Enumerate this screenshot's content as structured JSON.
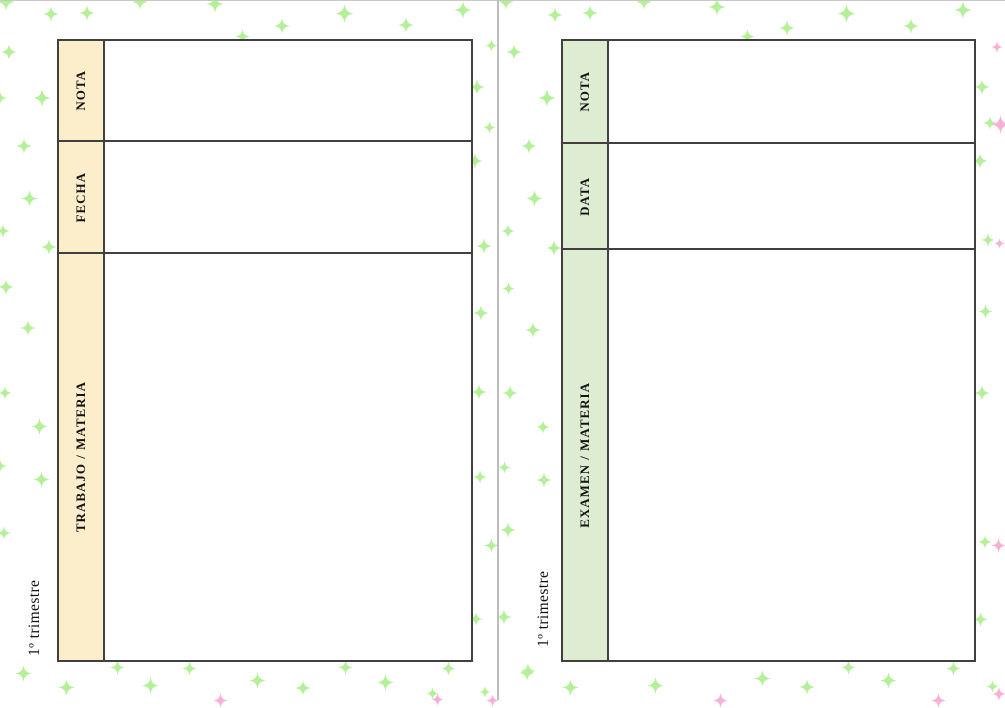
{
  "pages": {
    "left": {
      "title": "1º trimestre",
      "header_bg": "#fdeecb",
      "rows": [
        {
          "label": "NOTA"
        },
        {
          "label": "FECHA"
        },
        {
          "label": "TRABAJO / MATERIA"
        }
      ]
    },
    "right": {
      "title": "1º trimestre",
      "header_bg": "#deecd2",
      "rows": [
        {
          "label": "NOTA"
        },
        {
          "label": "DATA"
        },
        {
          "label": "EXAMEN / MATERIA"
        }
      ]
    }
  },
  "colors": {
    "table_border": "#404040",
    "page_divider": "#bdbdbd",
    "top_edge_line": "#c8c8c8",
    "text": "#131313"
  },
  "decor": {
    "sparkle_icon": "four-point-sparkle",
    "green": "#b4f098",
    "pink": "#f9b0d4",
    "green_sparkles": [
      [
        6,
        2,
        18
      ],
      [
        51,
        14,
        16
      ],
      [
        87,
        13,
        16
      ],
      [
        140,
        2,
        16
      ],
      [
        215,
        4,
        18
      ],
      [
        242,
        36,
        15
      ],
      [
        282,
        26,
        16
      ],
      [
        344,
        13,
        19
      ],
      [
        406,
        25,
        16
      ],
      [
        463,
        10,
        18
      ],
      [
        506,
        2,
        16
      ],
      [
        555,
        15,
        16
      ],
      [
        590,
        13,
        16
      ],
      [
        644,
        2,
        16
      ],
      [
        717,
        7,
        18
      ],
      [
        747,
        36,
        15
      ],
      [
        787,
        28,
        16
      ],
      [
        846,
        13,
        19
      ],
      [
        911,
        26,
        16
      ],
      [
        963,
        10,
        18
      ],
      [
        9,
        52,
        16
      ],
      [
        0,
        98,
        14
      ],
      [
        42,
        98,
        18
      ],
      [
        24,
        146,
        16
      ],
      [
        29,
        198,
        17
      ],
      [
        3,
        231,
        14
      ],
      [
        49,
        247,
        16
      ],
      [
        6,
        287,
        16
      ],
      [
        28,
        328,
        16
      ],
      [
        5,
        393,
        14
      ],
      [
        39,
        426,
        17
      ],
      [
        0,
        466,
        14
      ],
      [
        41,
        479,
        17
      ],
      [
        4,
        533,
        14
      ],
      [
        23,
        673,
        17
      ],
      [
        491,
        45,
        13
      ],
      [
        477,
        87,
        16
      ],
      [
        489,
        127,
        13
      ],
      [
        475,
        161,
        16
      ],
      [
        484,
        246,
        16
      ],
      [
        481,
        313,
        16
      ],
      [
        479,
        392,
        16
      ],
      [
        480,
        477,
        14
      ],
      [
        491,
        545,
        15
      ],
      [
        476,
        619,
        14
      ],
      [
        514,
        52,
        16
      ],
      [
        547,
        98,
        18
      ],
      [
        529,
        146,
        16
      ],
      [
        534,
        198,
        17
      ],
      [
        508,
        231,
        14
      ],
      [
        554,
        248,
        16
      ],
      [
        508,
        288,
        13
      ],
      [
        533,
        330,
        16
      ],
      [
        510,
        393,
        16
      ],
      [
        543,
        427,
        14
      ],
      [
        504,
        467,
        13
      ],
      [
        544,
        480,
        16
      ],
      [
        508,
        530,
        16
      ],
      [
        504,
        617,
        16
      ],
      [
        528,
        671,
        16
      ],
      [
        982,
        87,
        16
      ],
      [
        990,
        123,
        14
      ],
      [
        980,
        161,
        16
      ],
      [
        988,
        240,
        14
      ],
      [
        985,
        311,
        15
      ],
      [
        982,
        393,
        16
      ],
      [
        985,
        542,
        14
      ],
      [
        980,
        619,
        15
      ],
      [
        992,
        686,
        13
      ],
      [
        66,
        687,
        17
      ],
      [
        117,
        667,
        15
      ],
      [
        150,
        685,
        17
      ],
      [
        189,
        668,
        15
      ],
      [
        257,
        680,
        17
      ],
      [
        303,
        688,
        16
      ],
      [
        345,
        667,
        15
      ],
      [
        385,
        682,
        17
      ],
      [
        432,
        693,
        13
      ],
      [
        448,
        668,
        15
      ],
      [
        485,
        692,
        12
      ],
      [
        527,
        673,
        16
      ],
      [
        570,
        687,
        17
      ],
      [
        655,
        685,
        17
      ],
      [
        762,
        678,
        17
      ],
      [
        807,
        687,
        16
      ],
      [
        848,
        667,
        15
      ],
      [
        888,
        680,
        17
      ],
      [
        953,
        668,
        15
      ]
    ],
    "pink_sparkles": [
      [
        997,
        47,
        12
      ],
      [
        1000,
        124,
        19
      ],
      [
        999,
        243,
        11
      ],
      [
        998,
        545,
        15
      ],
      [
        999,
        694,
        14
      ],
      [
        220,
        700,
        15
      ],
      [
        437,
        699,
        13
      ],
      [
        492,
        700,
        13
      ],
      [
        720,
        700,
        15
      ],
      [
        938,
        700,
        15
      ]
    ]
  }
}
